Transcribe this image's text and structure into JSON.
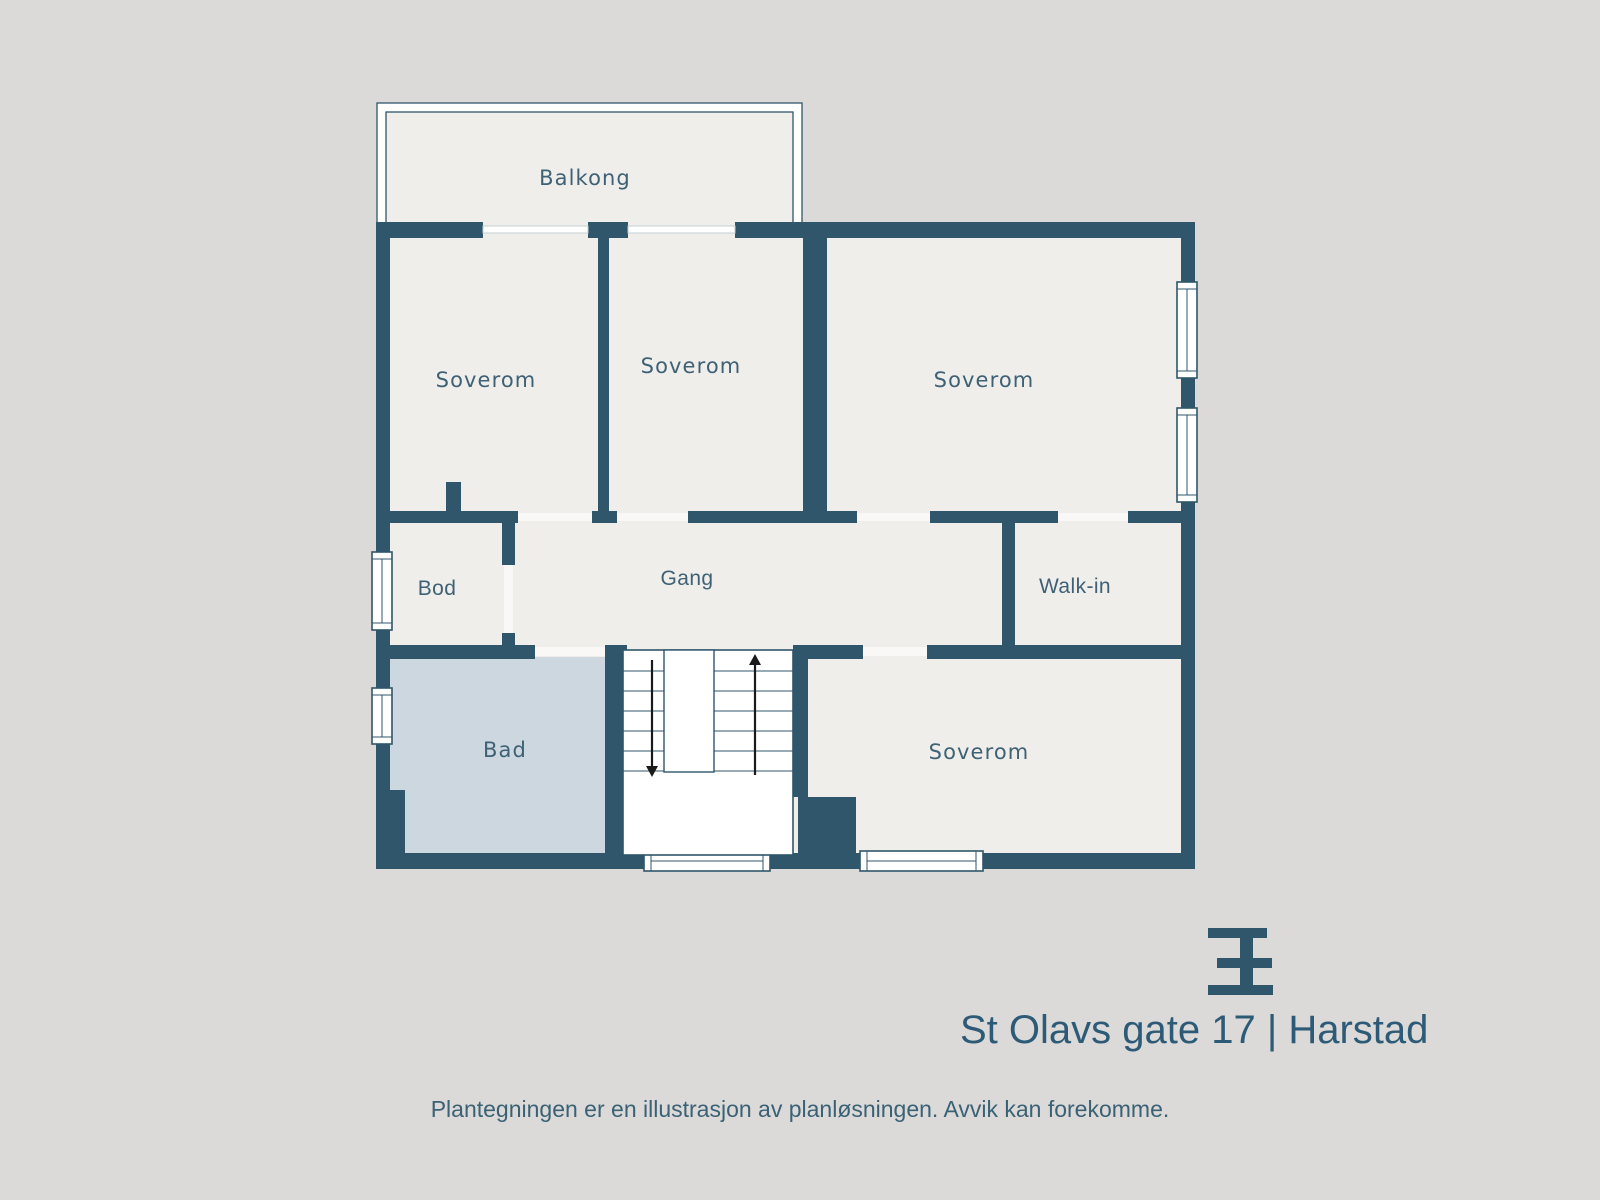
{
  "colors": {
    "background": "#dbdad8",
    "floor": "#efeeea",
    "wall": "#2f566b",
    "bad_floor": "#cdd7df",
    "white": "#ffffff",
    "label": "#3e6175",
    "brand": "#2f566b",
    "arrow": "#1a1a1a",
    "threshold": "rgba(255,255,255,0.6)",
    "door_glass_stroke": "#c3cdd3"
  },
  "plan": {
    "floor_rect": {
      "x": 376,
      "y": 222,
      "w": 819,
      "h": 647
    },
    "balcony": {
      "outer": {
        "x": 377,
        "y": 103,
        "w": 425,
        "h": 120
      },
      "inner": {
        "x": 386,
        "y": 112,
        "w": 407,
        "h": 111
      }
    },
    "walls": [
      {
        "x": 376,
        "y": 222,
        "w": 107,
        "h": 16
      },
      {
        "x": 588,
        "y": 222,
        "w": 40,
        "h": 16
      },
      {
        "x": 735,
        "y": 222,
        "w": 460,
        "h": 16
      },
      {
        "x": 376,
        "y": 222,
        "w": 14,
        "h": 647
      },
      {
        "x": 1181,
        "y": 222,
        "w": 14,
        "h": 647
      },
      {
        "x": 376,
        "y": 853,
        "w": 819,
        "h": 16
      },
      {
        "x": 390,
        "y": 511,
        "w": 128,
        "h": 12
      },
      {
        "x": 592,
        "y": 511,
        "w": 25,
        "h": 12
      },
      {
        "x": 688,
        "y": 511,
        "w": 169,
        "h": 12
      },
      {
        "x": 930,
        "y": 511,
        "w": 128,
        "h": 12
      },
      {
        "x": 1128,
        "y": 511,
        "w": 53,
        "h": 12
      },
      {
        "x": 598,
        "y": 232,
        "w": 11,
        "h": 291
      },
      {
        "x": 803,
        "y": 232,
        "w": 24,
        "h": 291
      },
      {
        "x": 502,
        "y": 511,
        "w": 13,
        "h": 54
      },
      {
        "x": 502,
        "y": 633,
        "w": 13,
        "h": 24
      },
      {
        "x": 1002,
        "y": 511,
        "w": 13,
        "h": 146
      },
      {
        "x": 376,
        "y": 645,
        "w": 159,
        "h": 14
      },
      {
        "x": 605,
        "y": 645,
        "w": 22,
        "h": 14
      },
      {
        "x": 793,
        "y": 645,
        "w": 70,
        "h": 14
      },
      {
        "x": 927,
        "y": 645,
        "w": 254,
        "h": 14
      },
      {
        "x": 605,
        "y": 645,
        "w": 18,
        "h": 210
      },
      {
        "x": 793,
        "y": 645,
        "w": 15,
        "h": 152
      },
      {
        "x": 798,
        "y": 797,
        "w": 58,
        "h": 58
      },
      {
        "x": 376,
        "y": 790,
        "w": 29,
        "h": 65
      },
      {
        "x": 446,
        "y": 482,
        "w": 15,
        "h": 41
      }
    ],
    "balcony_doors": [
      {
        "x": 483,
        "y": 222,
        "w": 105,
        "h": 16
      },
      {
        "x": 628,
        "y": 222,
        "w": 107,
        "h": 16
      }
    ],
    "thresholds": [
      {
        "x": 518,
        "y": 513,
        "w": 74,
        "h": 8
      },
      {
        "x": 617,
        "y": 513,
        "w": 71,
        "h": 8
      },
      {
        "x": 857,
        "y": 513,
        "w": 73,
        "h": 8
      },
      {
        "x": 1058,
        "y": 513,
        "w": 70,
        "h": 8
      },
      {
        "x": 504,
        "y": 565,
        "w": 9,
        "h": 68
      },
      {
        "x": 535,
        "y": 647,
        "w": 70,
        "h": 9
      },
      {
        "x": 863,
        "y": 647,
        "w": 64,
        "h": 9
      }
    ],
    "bad_floor": {
      "x": 390,
      "y": 657,
      "w": 215,
      "h": 198
    },
    "windows_vertical": [
      {
        "x": 1177,
        "y": 282,
        "w": 20,
        "h": 96
      },
      {
        "x": 1177,
        "y": 408,
        "w": 20,
        "h": 94
      },
      {
        "x": 372,
        "y": 552,
        "w": 20,
        "h": 78
      },
      {
        "x": 372,
        "y": 688,
        "w": 20,
        "h": 56
      }
    ],
    "windows_horizontal": [
      {
        "x": 644,
        "y": 851,
        "w": 126,
        "h": 20
      },
      {
        "x": 860,
        "y": 851,
        "w": 123,
        "h": 20
      }
    ],
    "stairs": {
      "box": {
        "x": 623,
        "y": 650,
        "w": 170,
        "h": 205
      },
      "treads_y": [
        671,
        691,
        711,
        731,
        751,
        771
      ],
      "void": {
        "x": 664,
        "y": 650,
        "w": 50,
        "h": 122
      },
      "arrow_down": {
        "x": 652,
        "y_tail": 660,
        "y_tip": 777
      },
      "arrow_up": {
        "x": 755,
        "y_tail": 775,
        "y_tip": 654
      }
    }
  },
  "labels": [
    {
      "id": "balkong",
      "text": "Balkong",
      "x": 585,
      "y": 185,
      "font": "geo",
      "size": 21
    },
    {
      "id": "soverom-1",
      "text": "Soverom",
      "x": 486,
      "y": 387,
      "font": "geo",
      "size": 21
    },
    {
      "id": "soverom-2",
      "text": "Soverom",
      "x": 691,
      "y": 373,
      "font": "geo",
      "size": 21
    },
    {
      "id": "soverom-3",
      "text": "Soverom",
      "x": 984,
      "y": 387,
      "font": "geo",
      "size": 21
    },
    {
      "id": "bod",
      "text": "Bod",
      "x": 437,
      "y": 595,
      "font": "sans",
      "size": 21
    },
    {
      "id": "gang",
      "text": "Gang",
      "x": 687,
      "y": 585,
      "font": "sans",
      "size": 21
    },
    {
      "id": "walk-in",
      "text": "Walk-in",
      "x": 1075,
      "y": 593,
      "font": "sans",
      "size": 21
    },
    {
      "id": "bad",
      "text": "Bad",
      "x": 505,
      "y": 757,
      "font": "geo",
      "size": 21
    },
    {
      "id": "soverom-4",
      "text": "Soverom",
      "x": 979,
      "y": 759,
      "font": "geo",
      "size": 21
    }
  ],
  "branding": {
    "address": "St Olavs gate 17 | Harstad",
    "logo_bars": [
      {
        "x": 1208,
        "y": 928,
        "w": 59,
        "h": 10
      },
      {
        "x": 1217,
        "y": 958,
        "w": 55,
        "h": 10
      },
      {
        "x": 1208,
        "y": 985,
        "w": 65,
        "h": 10
      },
      {
        "x": 1240,
        "y": 928,
        "w": 13,
        "h": 67
      }
    ]
  },
  "footer": {
    "disclaimer": "Plantegningen er en illustrasjon av planløsningen. Avvik kan forekomme."
  }
}
